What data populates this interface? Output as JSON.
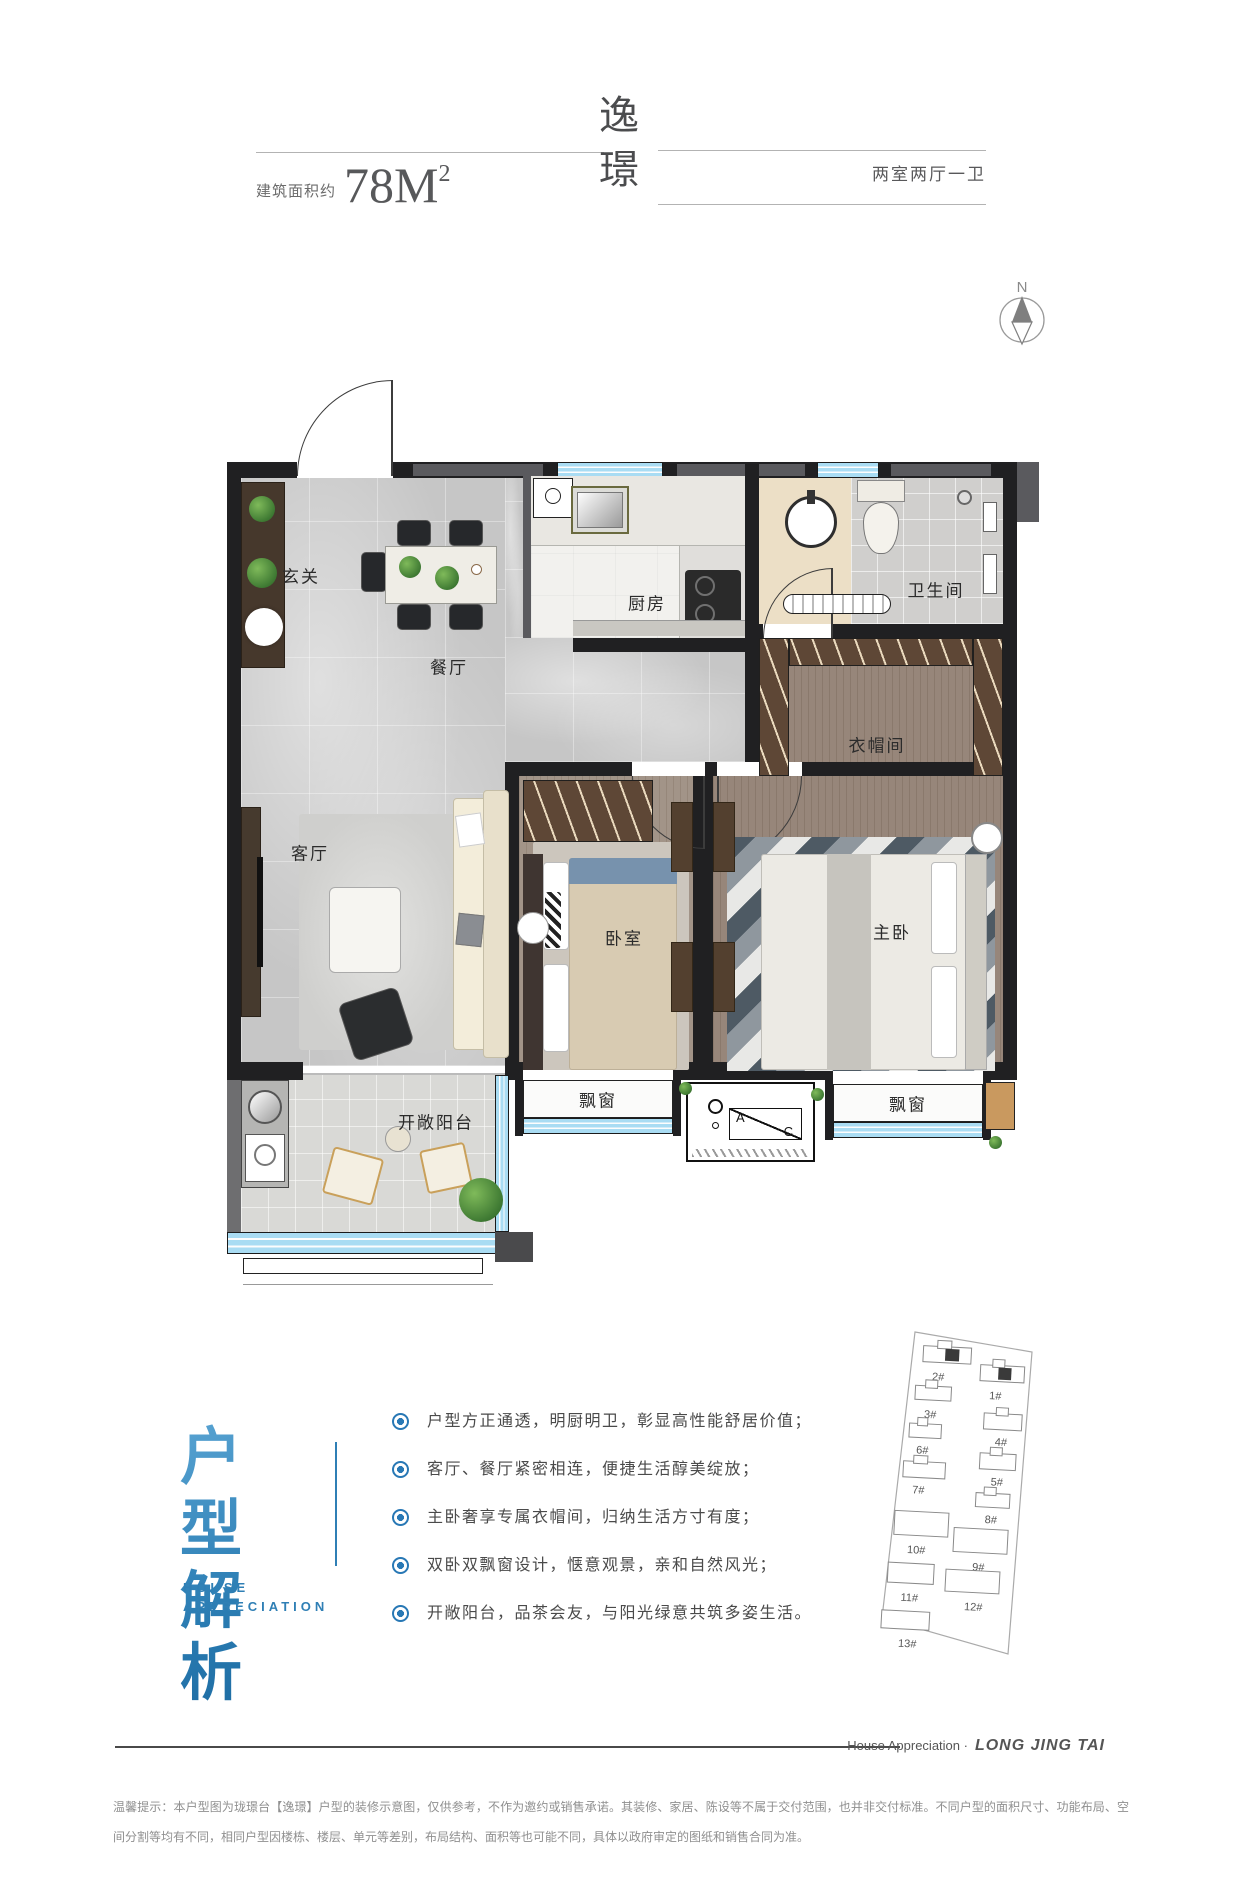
{
  "header": {
    "area_label": "建筑面积约",
    "area_value": "78M",
    "area_sup": "2",
    "title": "逸璟",
    "layout_label": "两室两厅一卫"
  },
  "compass": {
    "north": "N"
  },
  "plan": {
    "rooms": [
      {
        "label": "玄关"
      },
      {
        "label": "餐厅"
      },
      {
        "label": "厨房"
      },
      {
        "label": "卫生间"
      },
      {
        "label": "衣帽间"
      },
      {
        "label": "客厅"
      },
      {
        "label": "卧室"
      },
      {
        "label": "主卧"
      },
      {
        "label": "飘窗"
      },
      {
        "label": "飘窗"
      },
      {
        "label": "开敞阳台"
      }
    ],
    "ac": {
      "a": "A",
      "c": "C"
    }
  },
  "analysis": {
    "title_line1": "户型",
    "title_line2": "解析",
    "subtitle_line1": "HOUSE",
    "subtitle_line2": "APPRECIATION",
    "bullets": [
      "户型方正通透，明厨明卫，彰显高性能舒居价值；",
      "客厅、餐厅紧密相连，便捷生活醇美绽放；",
      "主卧奢享专属衣帽间，归纳生活方寸有度；",
      "双卧双飘窗设计，惬意观景，亲和自然风光；",
      "开敞阳台，品茶会友，与阳光绿意共筑多姿生活。"
    ]
  },
  "site_map": {
    "buildings": [
      "2#",
      "1#",
      "3#",
      "4#",
      "6#",
      "5#",
      "7#",
      "8#",
      "10#",
      "9#",
      "11#",
      "12#",
      "13#"
    ]
  },
  "footer": {
    "brand_prefix": "House Appreciation ·",
    "brand_name": "LONG JING TAI",
    "disclaimer": "温馨提示：本户型图为珑璟台【逸璟】户型的装修示意图，仅供参考，不作为邀约或销售承诺。其装修、家居、陈设等不属于交付范围，也并非交付标准。不同户型的面积尺寸、功能布局、空间分割等均有不同，相同户型因楼栋、楼层、单元等差别，布局结构、面积等也可能不同，具体以政府审定的图纸和销售合同为准。"
  },
  "colors": {
    "accent_blue": "#2878b5",
    "title_blue_light": "#58a3d2",
    "title_blue_dark": "#1a689f",
    "window_blue": "#a9dcf3",
    "wall_dark": "#202022",
    "wood_floor": "#97867a",
    "marble_floor": "#c6c6c6",
    "bath_beige": "#ecdfc6"
  }
}
